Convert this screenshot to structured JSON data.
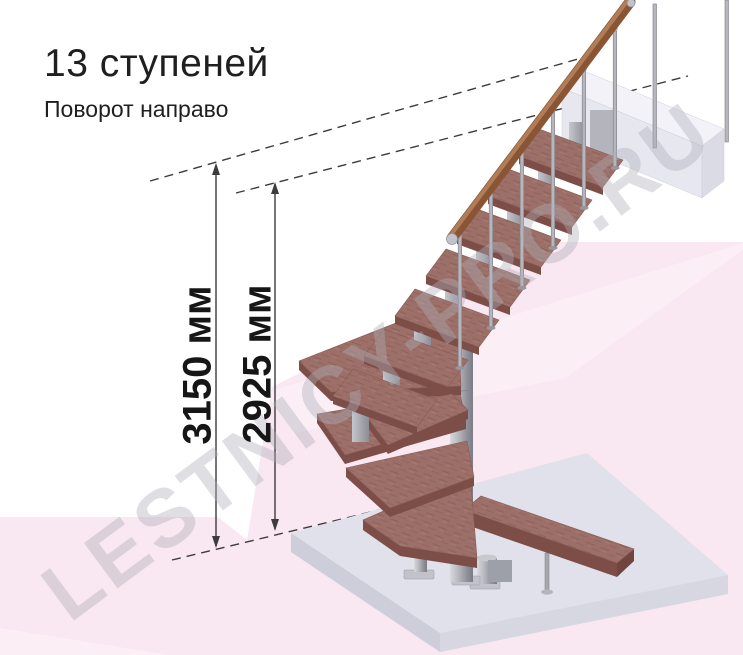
{
  "header": {
    "title": "13 ступеней",
    "subtitle": "Поворот направо"
  },
  "dimensions": {
    "total_height": {
      "label": "3150 мм",
      "value_mm": 3150
    },
    "to_top_step": {
      "label": "2925 мм",
      "value_mm": 2925
    }
  },
  "stair": {
    "steps_count": 13,
    "turn_direction": "направо"
  },
  "watermark": {
    "text": "LESTNICY-PRO.RU"
  },
  "colors": {
    "wood_tread_top": "#9c6f68",
    "wood_tread_front": "#7d4e48",
    "handrail_wood": "#8a5535",
    "metal_gray": "#b0b0b8",
    "floor_slab_top": "#e0e1ea",
    "upper_beam": "#e7e7f0",
    "background_pink": "#f9e7f1",
    "dimension_line": "#3c3c3c",
    "text_color": "#1f1f1f",
    "watermark_gray": "#b0b0b8"
  }
}
